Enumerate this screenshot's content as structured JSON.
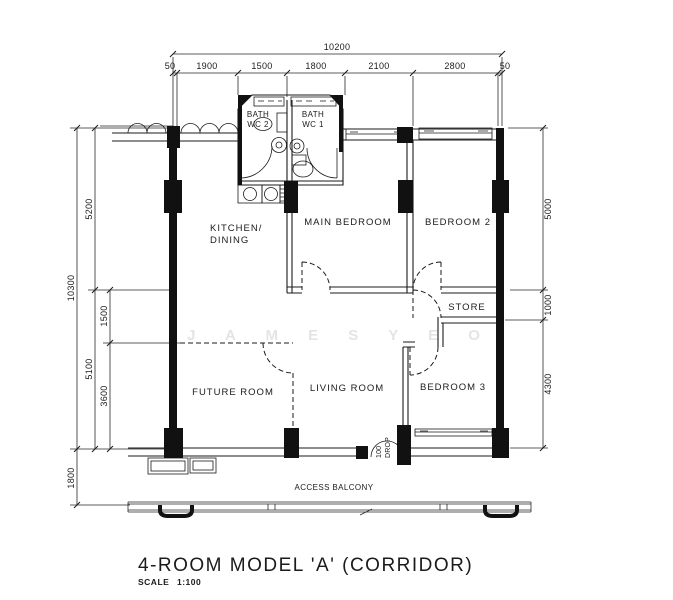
{
  "title": "4-ROOM MODEL 'A' (CORRIDOR)",
  "scale": {
    "label": "SCALE",
    "value": "1:100"
  },
  "watermark": "J A M E S   Y E O",
  "colors": {
    "ink": "#1b1b1b",
    "paper": "#ffffff",
    "watermark": "#e4e4e4"
  },
  "rooms": {
    "kitchen_line1": "KITCHEN/",
    "kitchen_line2": "DINING",
    "main_bedroom": "MAIN BEDROOM",
    "bedroom2": "BEDROOM 2",
    "bedroom3": "BEDROOM 3",
    "store": "STORE",
    "living_room": "LIVING ROOM",
    "future_room": "FUTURE ROOM",
    "bath1_line1": "BATH",
    "bath1_line2": "WC 1",
    "bath2_line1": "BATH",
    "bath2_line2": "WC 2",
    "access_balcony": "ACCESS BALCONY",
    "drop_line1": "100",
    "drop_line2": "DROP"
  },
  "dimensions": {
    "overall_width": "10200",
    "top_segments": [
      "50",
      "1900",
      "1500",
      "1800",
      "2100",
      "2800",
      "50"
    ],
    "left_overall": "10300",
    "left_balcony": "1800",
    "left_upper": "5200",
    "left_lower": "5100",
    "left_inner_upper": "1500",
    "left_inner_lower": "3600",
    "right_upper": "5000",
    "right_middle": "1000",
    "right_lower": "4300"
  }
}
